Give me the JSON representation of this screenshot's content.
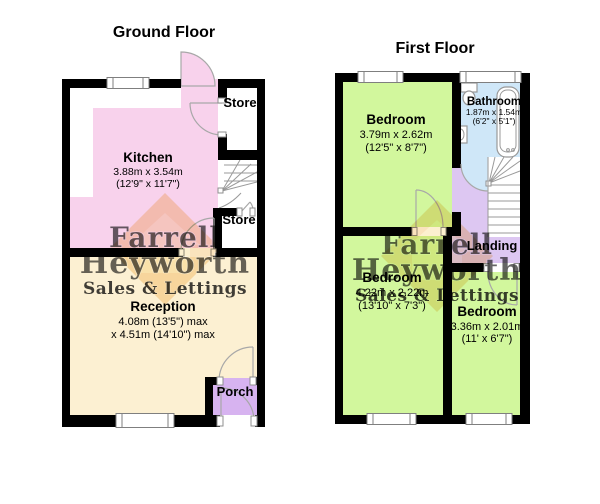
{
  "ground_floor": {
    "title": "Ground Floor",
    "rooms": {
      "kitchen": {
        "name": "Kitchen",
        "dim_metric": "3.88m x 3.54m",
        "dim_imperial": "(12'9\" x 11'7\")",
        "color": "#f8d2ec"
      },
      "reception": {
        "name": "Reception",
        "dim_line1": "4.08m (13'5\") max",
        "dim_line2": "x 4.51m (14'10\") max",
        "color": "#fcf0d2"
      },
      "store_top": {
        "name": "Store"
      },
      "store_bottom": {
        "name": "Store"
      },
      "porch": {
        "name": "Porch",
        "color": "#d7b3f0"
      }
    }
  },
  "first_floor": {
    "title": "First Floor",
    "rooms": {
      "bedroom1": {
        "name": "Bedroom",
        "dim_metric": "3.79m x 2.62m",
        "dim_imperial": "(12'5\" x 8'7\")",
        "color": "#d2f79d"
      },
      "bathroom": {
        "name": "Bathroom",
        "dim_metric": "1.87m x 1.54m",
        "dim_imperial": "(6'2\" x 5'1\")",
        "color": "#cfe7f8"
      },
      "bedroom2": {
        "name": "Bedroom",
        "dim_metric": "4.22m x 2.22m",
        "dim_imperial": "(13'10\" x 7'3\")",
        "color": "#d2f79d"
      },
      "bedroom3": {
        "name": "Bedroom",
        "dim_metric": "3.36m x 2.01m",
        "dim_imperial": "(11' x 6'7\")",
        "color": "#d2f79d"
      },
      "landing": {
        "name": "Landing",
        "color": "#ddc7f2"
      }
    }
  },
  "watermark": {
    "line1": "Farrell",
    "line2": "Heyworth",
    "tagline": "Sales & Lettings",
    "diamond_color": "#f6c77c",
    "house_color": "#fdf2d2",
    "text_color": "#7d76a6",
    "tagline_color": "#f0a0a8"
  },
  "colors": {
    "wall": "#000000"
  }
}
